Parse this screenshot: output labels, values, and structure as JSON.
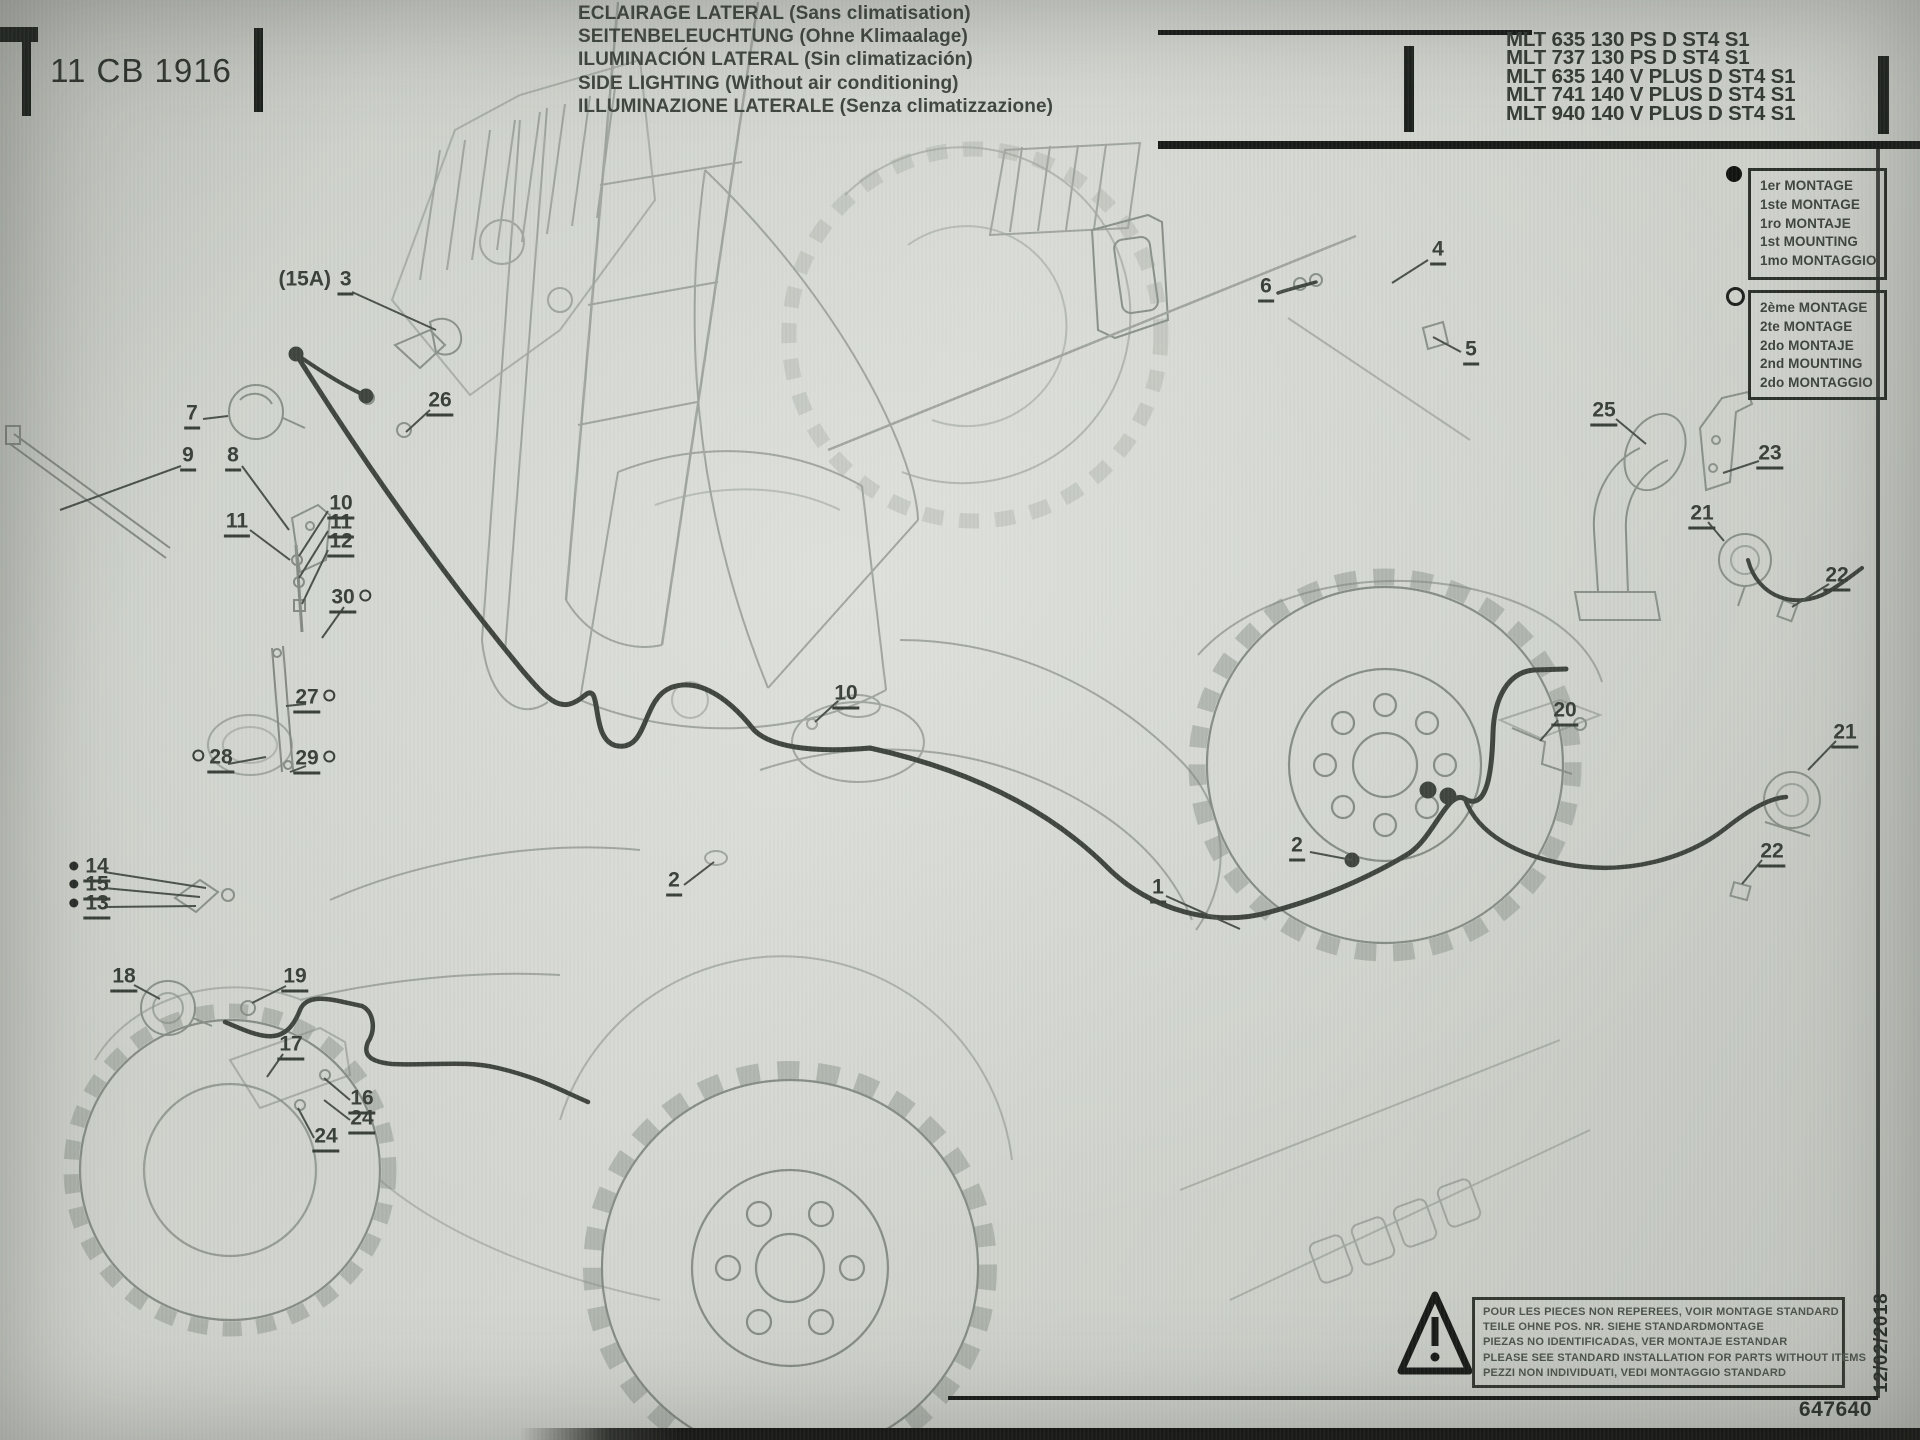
{
  "page": {
    "ref": "11 CB 1916",
    "doc_number": "647640",
    "date": "12/02/2018"
  },
  "header": {
    "titles": [
      "ECLAIRAGE LATERAL (Sans climatisation)",
      "SEITENBELEUCHTUNG (Ohne Klimaalage)",
      "ILUMINACIÓN LATERAL (Sin climatización)",
      "SIDE LIGHTING (Without air conditioning)",
      "ILLUMINAZIONE LATERALE (Senza climatizzazione)"
    ],
    "models": [
      "MLT 635 130 PS D ST4 S1",
      "MLT 737 130 PS D ST4 S1",
      "MLT 635 140 V PLUS D ST4 S1",
      "MLT 741 140 V PLUS D ST4 S1",
      "MLT 940 140 V PLUS D ST4 S1"
    ]
  },
  "legend": {
    "first_mount": {
      "symbol": "filled-circle",
      "lines": [
        "1er MONTAGE",
        "1ste MONTAGE",
        "1ro MONTAJE",
        "1st MOUNTING",
        "1mo MONTAGGIO"
      ]
    },
    "second_mount": {
      "symbol": "open-circle",
      "lines": [
        "2ème MONTAGE",
        "2te MONTAGE",
        "2do MONTAJE",
        "2nd MOUNTING",
        "2do MONTAGGIO"
      ]
    }
  },
  "warning": {
    "lines": [
      "POUR LES PIECES NON REPEREES, VOIR MONTAGE STANDARD",
      "TEILE OHNE POS. NR. SIEHE STANDARDMONTAGE",
      "PIEZAS NO IDENTIFICADAS, VER MONTAJE ESTANDAR",
      "PLEASE SEE STANDARD INSTALLATION FOR PARTS WITHOUT ITEMS",
      "PEZZI NON INDIVIDUATI, VEDI MONTAGGIO STANDARD"
    ]
  },
  "callouts": [
    {
      "label": "3",
      "prefix": "(15A) ",
      "x": 316,
      "y": 279,
      "leader": [
        352,
        292,
        436,
        330
      ]
    },
    {
      "label": "26",
      "x": 440,
      "y": 400,
      "leader": [
        430,
        410,
        406,
        432
      ]
    },
    {
      "label": "7",
      "x": 192,
      "y": 413,
      "leader": [
        203,
        419,
        228,
        416
      ]
    },
    {
      "label": "9",
      "x": 188,
      "y": 455,
      "leader": [
        181,
        466,
        60,
        510
      ]
    },
    {
      "label": "8",
      "x": 233,
      "y": 455,
      "leader": [
        242,
        466,
        289,
        530
      ]
    },
    {
      "label": "11",
      "x": 237,
      "y": 521,
      "leader": [
        250,
        530,
        290,
        560
      ]
    },
    {
      "label": "10",
      "x": 341,
      "y": 503,
      "leader": [
        328,
        511,
        299,
        556
      ]
    },
    {
      "label": "11",
      "x": 341,
      "y": 522,
      "leader": [
        328,
        531,
        299,
        578
      ]
    },
    {
      "label": "12",
      "x": 341,
      "y": 541,
      "leader": [
        328,
        550,
        302,
        604
      ]
    },
    {
      "label": "30",
      "x": 352,
      "y": 597,
      "sym": "circle-after",
      "leader": [
        344,
        607,
        322,
        638
      ]
    },
    {
      "label": "27",
      "x": 316,
      "y": 697,
      "sym": "circle-after",
      "leader": [
        306,
        704,
        286,
        706
      ]
    },
    {
      "label": "28",
      "x": 212,
      "y": 757,
      "sym": "circle-before",
      "leader": [
        228,
        764,
        266,
        757
      ]
    },
    {
      "label": "29",
      "x": 316,
      "y": 758,
      "sym": "circle-after",
      "leader": [
        306,
        766,
        290,
        772
      ]
    },
    {
      "label": "14",
      "x": 90,
      "y": 866,
      "sym": "bullet-before",
      "leader": [
        104,
        872,
        206,
        888
      ]
    },
    {
      "label": "15",
      "x": 90,
      "y": 884,
      "sym": "bullet-before",
      "leader": [
        104,
        888,
        200,
        897
      ]
    },
    {
      "label": "13",
      "x": 90,
      "y": 903,
      "sym": "bullet-before",
      "leader": [
        104,
        907,
        196,
        906
      ]
    },
    {
      "label": "18",
      "x": 124,
      "y": 976,
      "leader": [
        134,
        985,
        160,
        999
      ]
    },
    {
      "label": "19",
      "x": 295,
      "y": 976,
      "leader": [
        286,
        986,
        252,
        1003
      ]
    },
    {
      "label": "17",
      "x": 291,
      "y": 1044,
      "leader": [
        283,
        1054,
        267,
        1077
      ]
    },
    {
      "label": "16",
      "x": 362,
      "y": 1098,
      "leader": [
        350,
        1100,
        324,
        1078
      ]
    },
    {
      "label": "24",
      "x": 362,
      "y": 1118,
      "leader": [
        350,
        1120,
        324,
        1100
      ]
    },
    {
      "label": "24",
      "x": 326,
      "y": 1136,
      "leader": [
        314,
        1138,
        298,
        1108
      ]
    },
    {
      "label": "2",
      "x": 674,
      "y": 880,
      "leader": [
        684,
        885,
        714,
        862
      ]
    },
    {
      "label": "10",
      "x": 846,
      "y": 693,
      "leader": [
        838,
        701,
        815,
        722
      ]
    },
    {
      "label": "1",
      "x": 1158,
      "y": 887,
      "leader": [
        1166,
        896,
        1240,
        929
      ]
    },
    {
      "label": "2",
      "x": 1297,
      "y": 845,
      "leader": [
        1310,
        852,
        1352,
        860
      ]
    },
    {
      "label": "4",
      "x": 1438,
      "y": 249,
      "leader": [
        1428,
        260,
        1392,
        283
      ]
    },
    {
      "label": "6",
      "x": 1266,
      "y": 286,
      "leader": [
        1278,
        293,
        1298,
        286
      ]
    },
    {
      "label": "5",
      "x": 1471,
      "y": 349,
      "leader": [
        1461,
        352,
        1433,
        337
      ]
    },
    {
      "label": "25",
      "x": 1604,
      "y": 410,
      "leader": [
        1616,
        419,
        1646,
        444
      ]
    },
    {
      "label": "23",
      "x": 1770,
      "y": 453,
      "leader": [
        1759,
        461,
        1723,
        473
      ]
    },
    {
      "label": "21",
      "x": 1702,
      "y": 513,
      "leader": [
        1708,
        522,
        1724,
        541
      ]
    },
    {
      "label": "22",
      "x": 1837,
      "y": 575,
      "leader": [
        1829,
        584,
        1792,
        607
      ]
    },
    {
      "label": "20",
      "x": 1565,
      "y": 710,
      "leader": [
        1558,
        720,
        1540,
        741
      ]
    },
    {
      "label": "21",
      "x": 1845,
      "y": 732,
      "leader": [
        1836,
        741,
        1808,
        770
      ]
    },
    {
      "label": "22",
      "x": 1772,
      "y": 851,
      "leader": [
        1762,
        860,
        1742,
        884
      ]
    }
  ]
}
